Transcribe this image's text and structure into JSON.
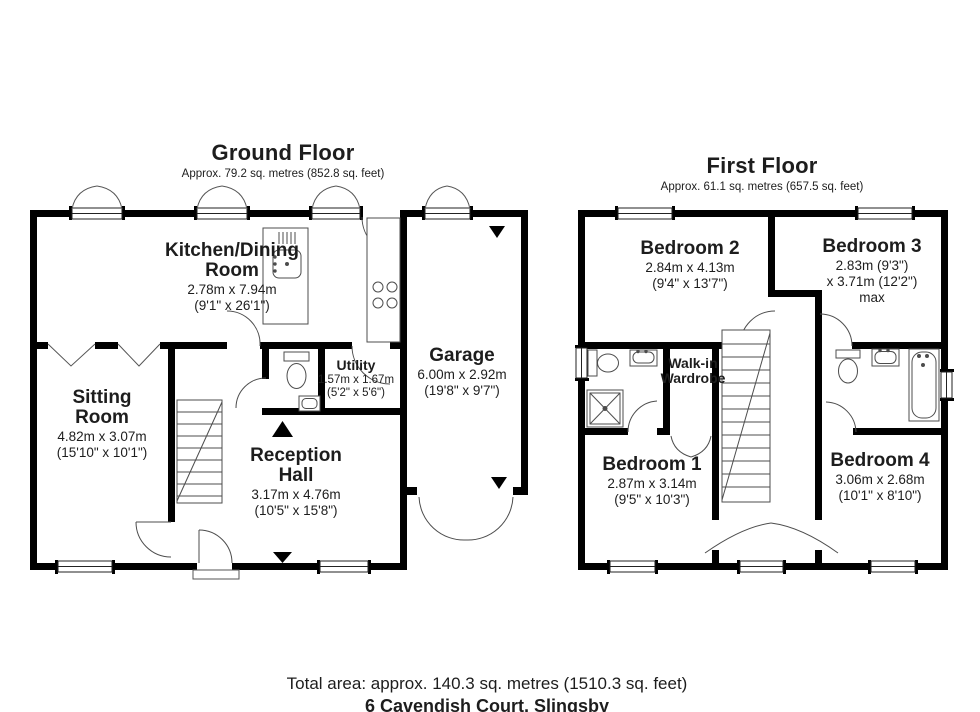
{
  "floors": {
    "ground": {
      "title": "Ground Floor",
      "subtitle": "Approx. 79.2 sq. metres (852.8 sq. feet)",
      "rooms": {
        "kitchen": {
          "name": "Kitchen/Dining\nRoom",
          "dims": "2.78m x 7.94m\n(9'1\" x 26'1\")"
        },
        "sitting": {
          "name": "Sitting\nRoom",
          "dims": "4.82m x 3.07m\n(15'10\" x 10'1\")"
        },
        "utility": {
          "name": "Utility",
          "dims": "1.57m x 1.67m\n(5'2\" x 5'6\")"
        },
        "reception": {
          "name": "Reception\nHall",
          "dims": "3.17m x 4.76m\n(10'5\" x 15'8\")"
        },
        "garage": {
          "name": "Garage",
          "dims": "6.00m x 2.92m\n(19'8\" x 9'7\")"
        }
      }
    },
    "first": {
      "title": "First Floor",
      "subtitle": "Approx. 61.1 sq. metres (657.5 sq. feet)",
      "rooms": {
        "bedroom2": {
          "name": "Bedroom 2",
          "dims": "2.84m x 4.13m\n(9'4\" x 13'7\")"
        },
        "bedroom3": {
          "name": "Bedroom 3",
          "dims": "2.83m (9'3\")\nx 3.71m (12'2\") max"
        },
        "wardrobe": {
          "name": "Walk-in\nWardrobe",
          "dims": ""
        },
        "bedroom1": {
          "name": "Bedroom 1",
          "dims": "2.87m x 3.14m\n(9'5\" x 10'3\")"
        },
        "bedroom4": {
          "name": "Bedroom 4",
          "dims": "3.06m x 2.68m\n(10'1\" x 8'10\")"
        }
      }
    }
  },
  "footer": {
    "total_area": "Total area: approx. 140.3 sq. metres (1510.3 sq. feet)",
    "address": "6 Cavendish Court, Slingsby"
  },
  "colors": {
    "wall": "#000000",
    "fixture_line": "#4d4d4d",
    "background": "#ffffff",
    "text": "#1d1d1d"
  }
}
